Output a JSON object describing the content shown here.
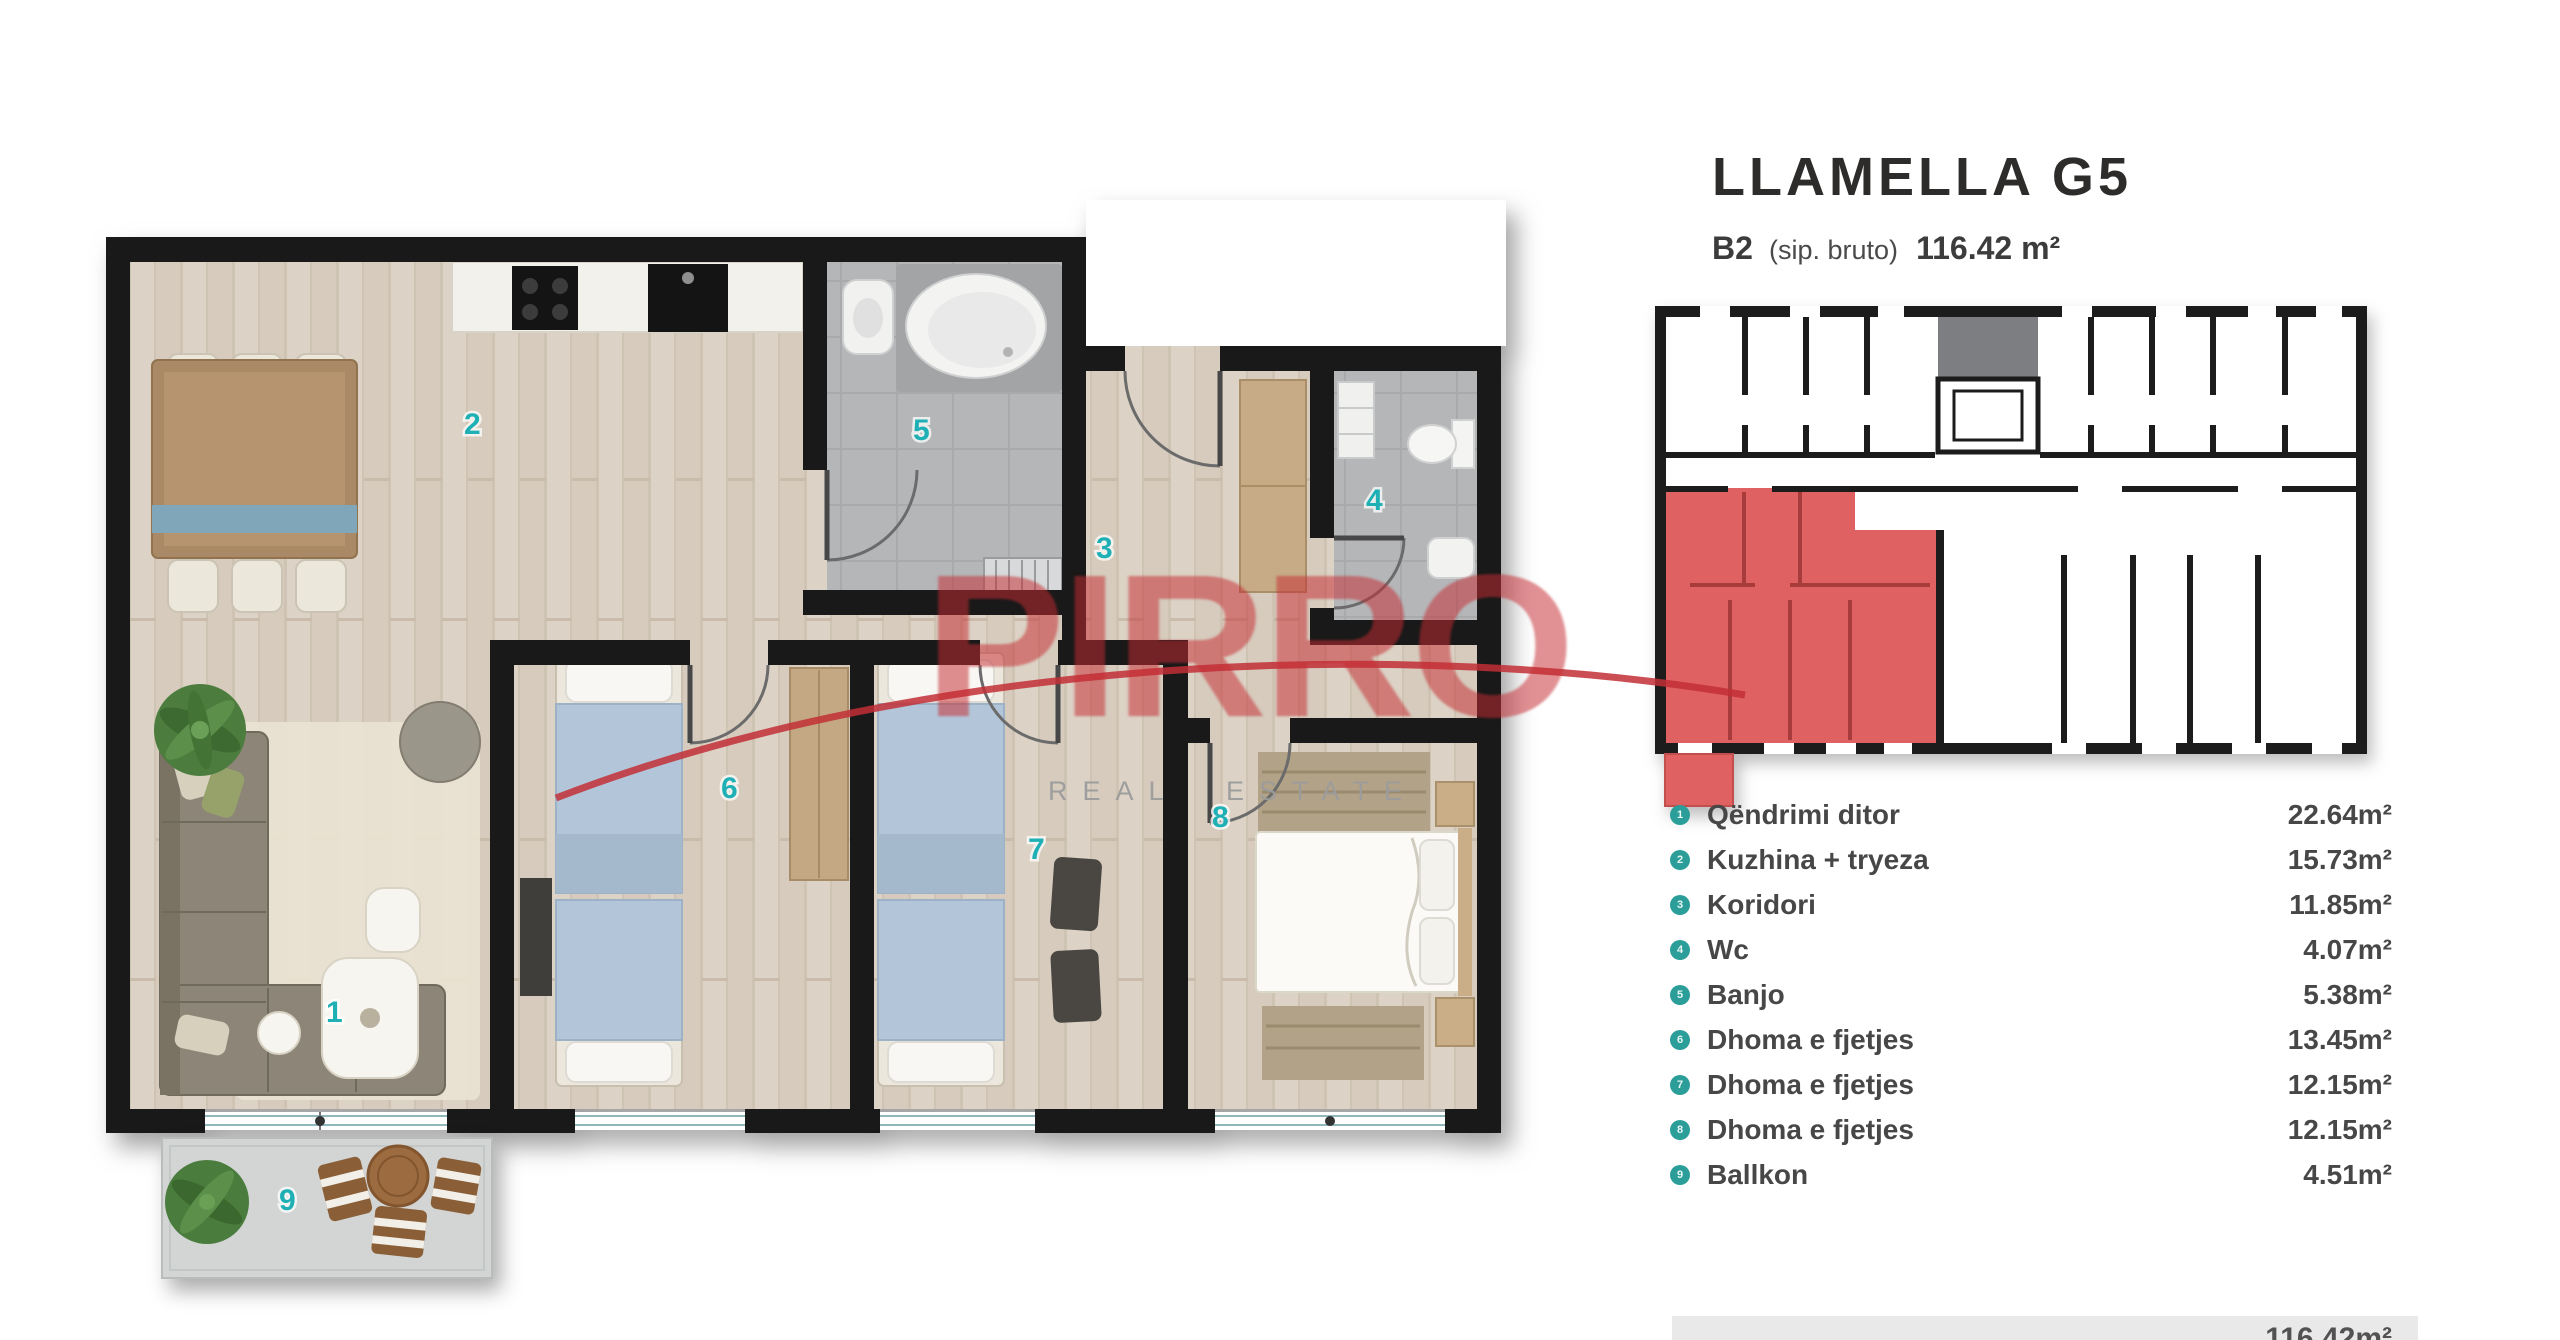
{
  "header": {
    "title": "LLAMELLA G5",
    "unit_code": "B2",
    "unit_note": "(sip. bruto)",
    "unit_area": "116.42 m²"
  },
  "watermark": {
    "brand": "PIRRO",
    "tagline": "REAL ESTATE",
    "brand_color": "#c62c32"
  },
  "rooms": [
    {
      "num": "1",
      "name": "Qëndrimi ditor",
      "area": "22.64m²"
    },
    {
      "num": "2",
      "name": "Kuzhina + tryeza",
      "area": "15.73m²"
    },
    {
      "num": "3",
      "name": "Koridori",
      "area": "11.85m²"
    },
    {
      "num": "4",
      "name": "Wc",
      "area": "4.07m²"
    },
    {
      "num": "5",
      "name": "Banjo",
      "area": "5.38m²"
    },
    {
      "num": "6",
      "name": "Dhoma e fjetjes",
      "area": "13.45m²"
    },
    {
      "num": "7",
      "name": "Dhoma e fjetjes",
      "area": "12.15m²"
    },
    {
      "num": "8",
      "name": "Dhoma e fjetjes",
      "area": "12.15m²"
    },
    {
      "num": "9",
      "name": "Ballkon",
      "area": "4.51m²"
    }
  ],
  "total_area": "116.42m²",
  "colors": {
    "accent_teal": "#1fb0b6",
    "list_bullet_teal": "#2b9e99",
    "keyplan_highlight": "#e06161",
    "wall": "#191919"
  }
}
